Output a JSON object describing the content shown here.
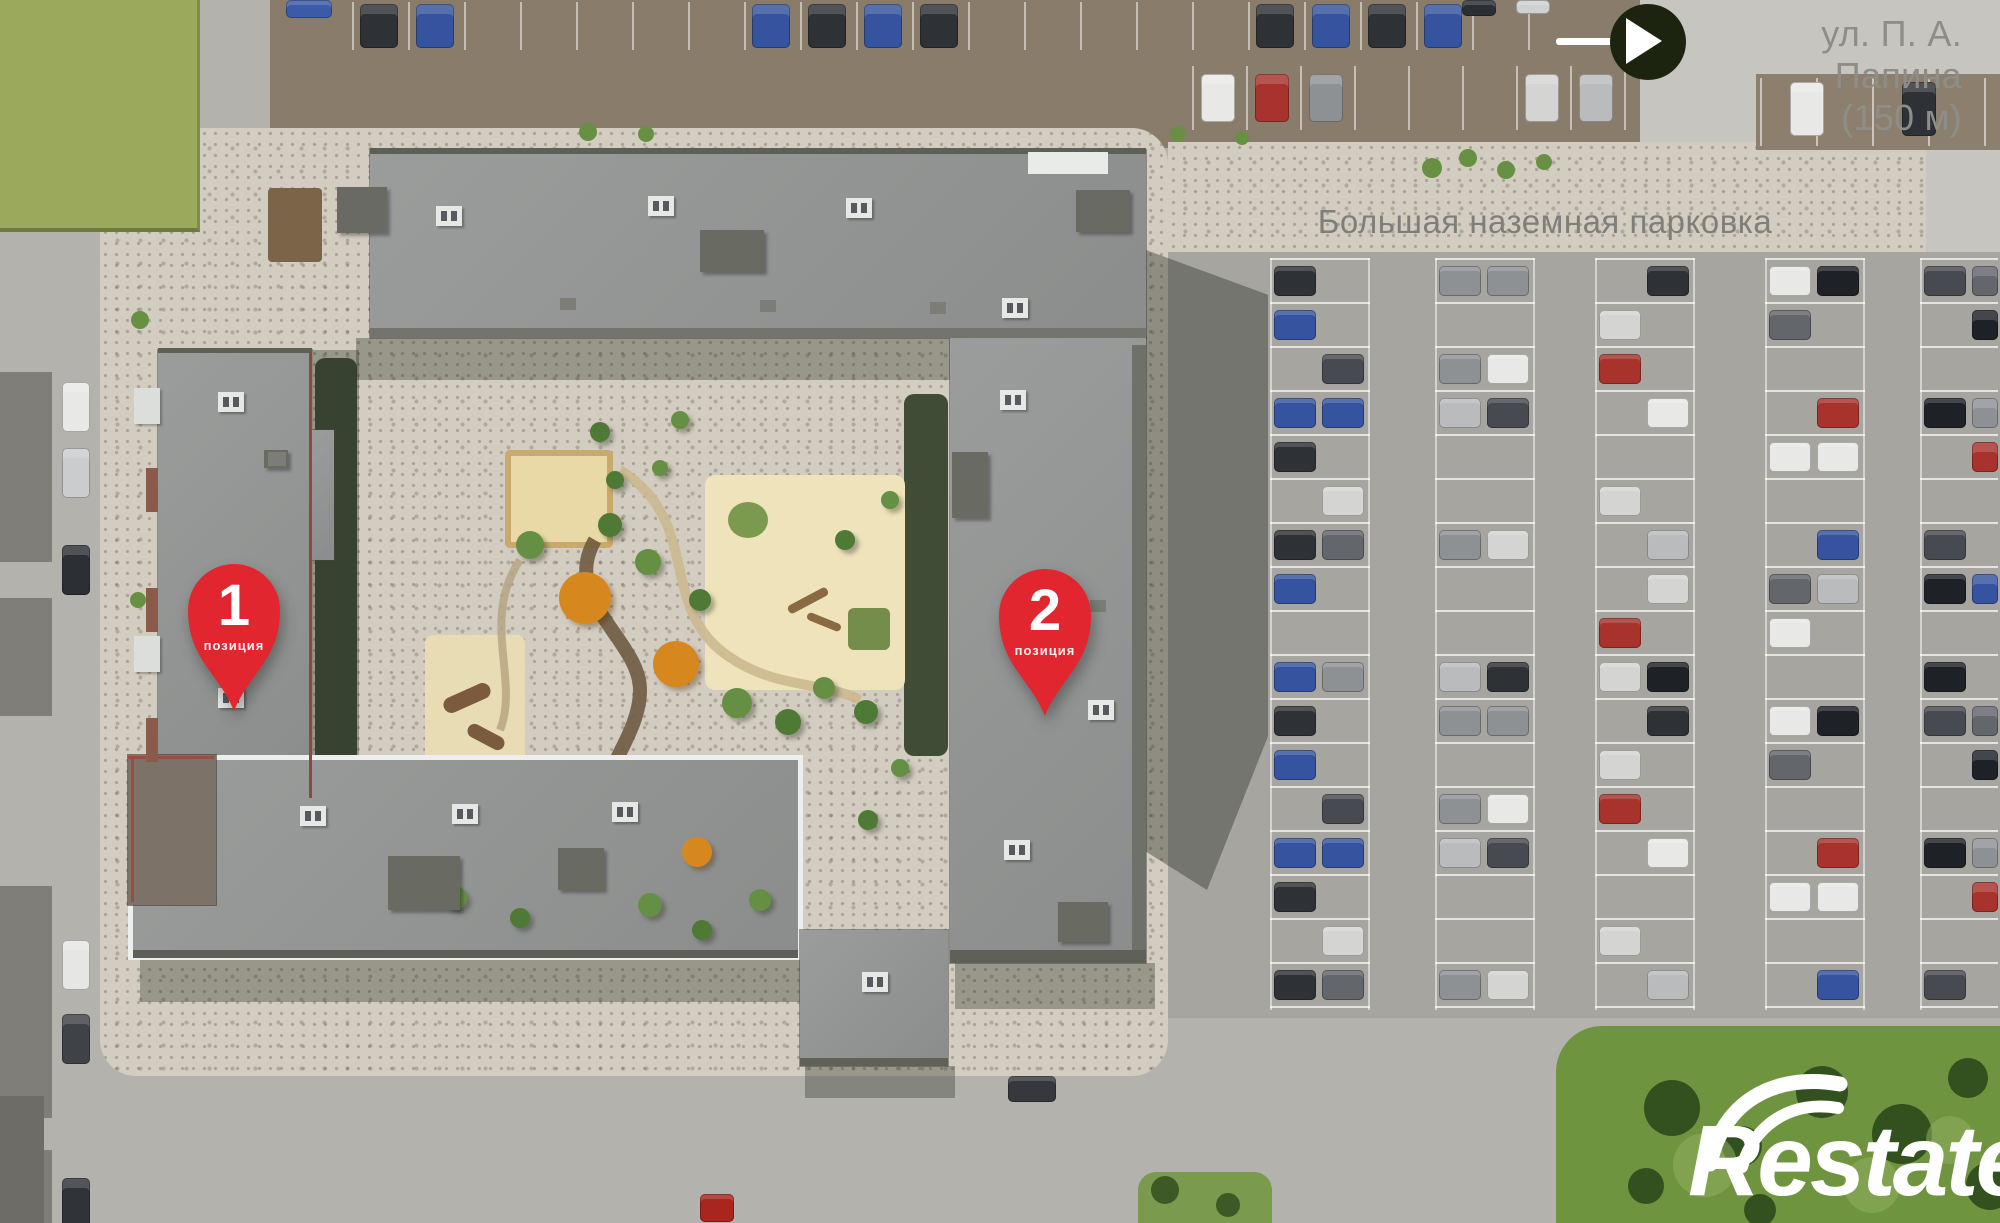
{
  "street_label": {
    "line1": "ул. П. А. Папина",
    "line2": "(150 м)"
  },
  "parking_label": "Большая наземная парковка",
  "pins": [
    {
      "number": "1",
      "label": "позиция"
    },
    {
      "number": "2",
      "label": "позиция"
    }
  ],
  "watermark": "Restate",
  "colors": {
    "pin_red": "#e2262f",
    "street_gray": "#8e8e88",
    "label_gray": "#7f7f79",
    "arrow_circle": "#1c2410",
    "watermark_white": "#ffffff"
  }
}
